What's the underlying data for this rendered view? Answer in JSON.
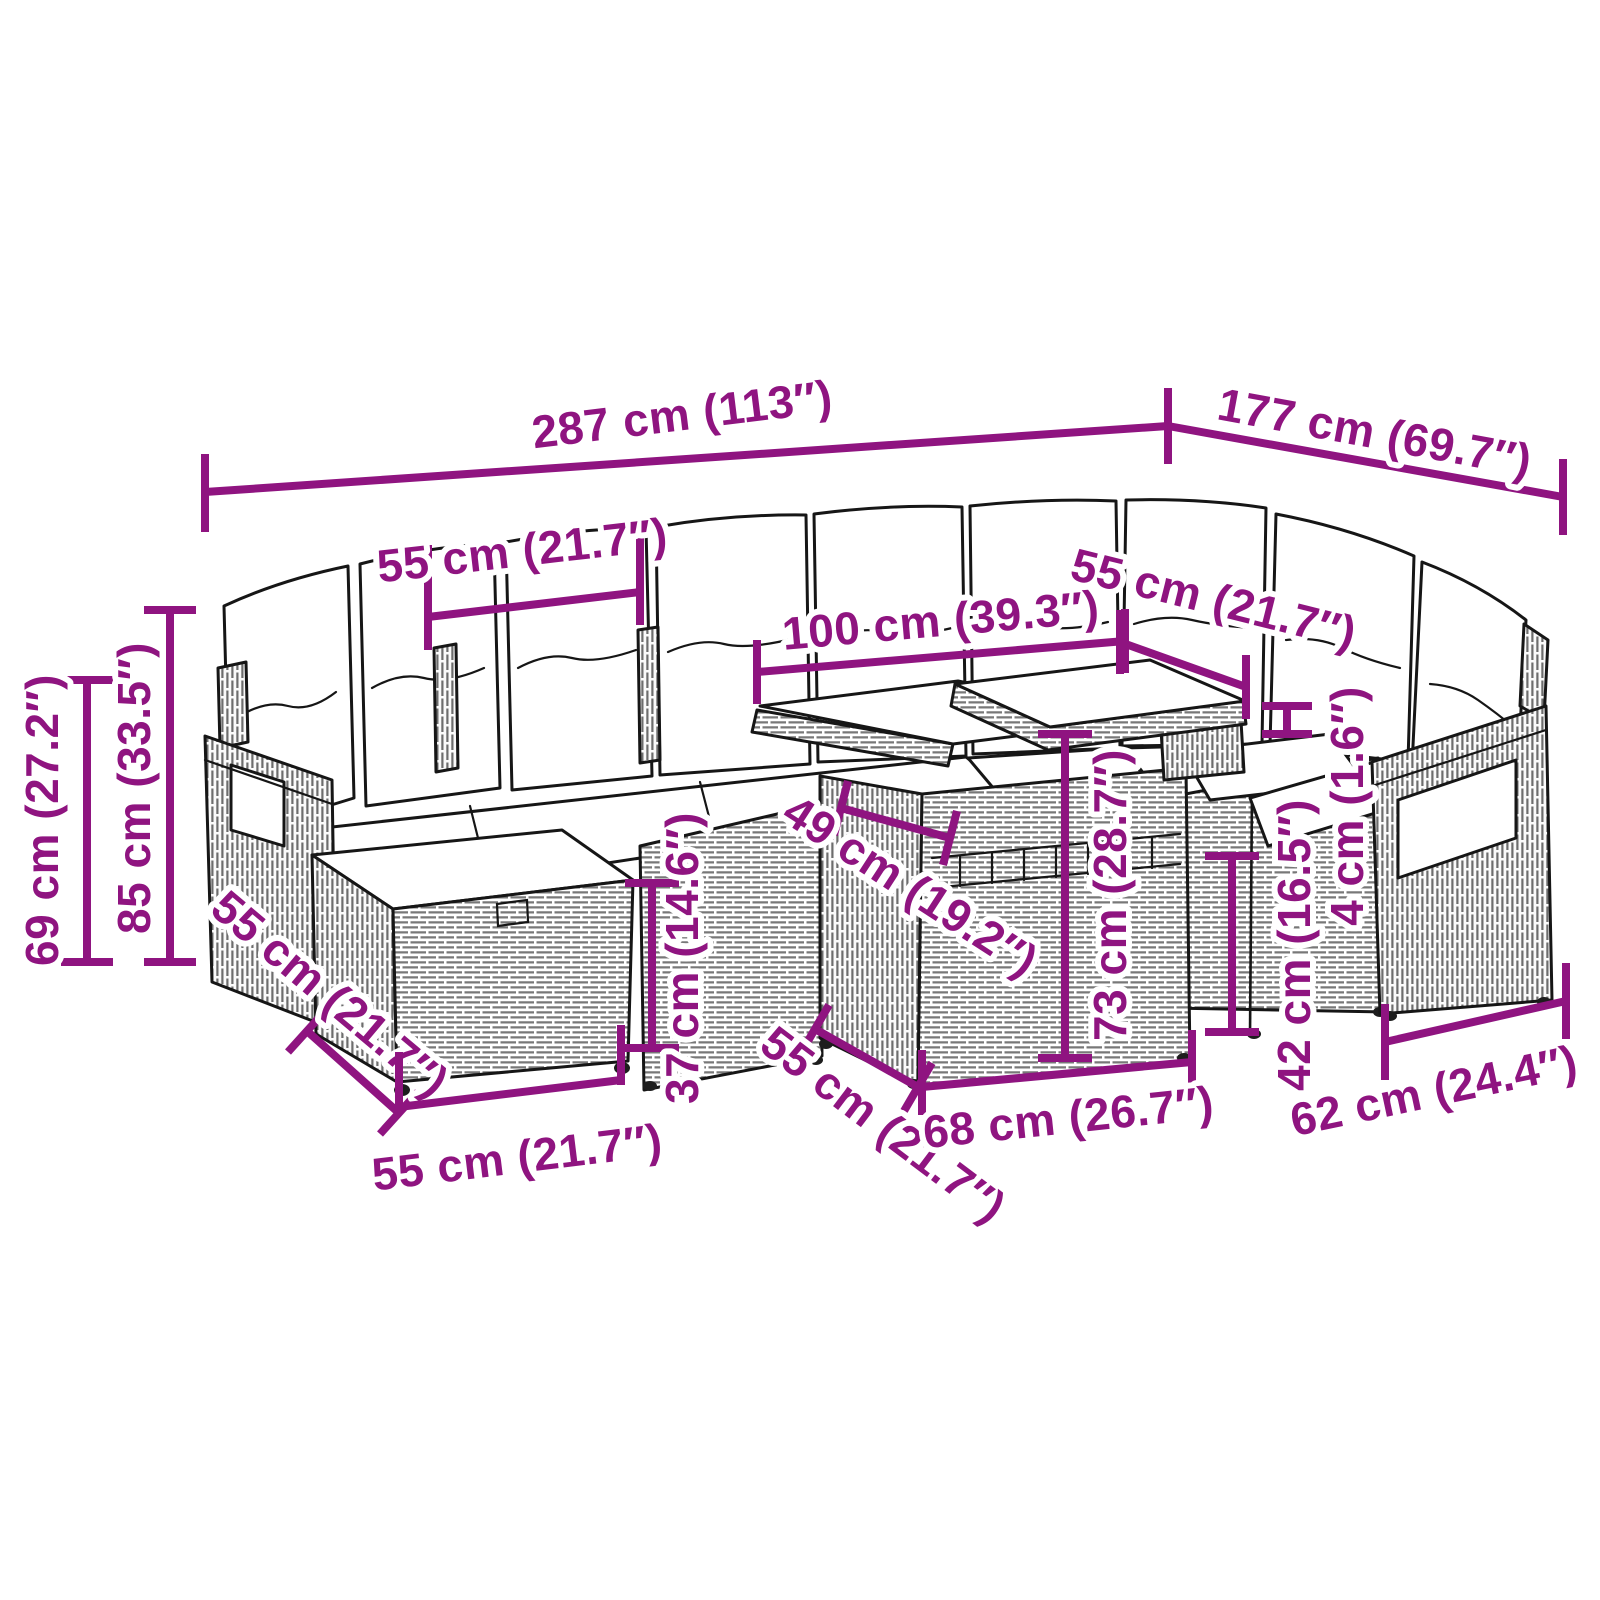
{
  "colors": {
    "accent": "#8F1480",
    "line_art": "#161616",
    "background": "#ffffff"
  },
  "illustration": {
    "style": "black-and-white line art",
    "subject": "poly-rattan corner sofa set with back pillows, seat cushions, ottomans and a two-top table"
  },
  "dimensions": [
    {
      "id": "overall-width",
      "label": "287 cm (113″)",
      "cm": 287,
      "inches": 113
    },
    {
      "id": "overall-depth",
      "label": "177 cm (69.7″)",
      "cm": 177,
      "inches": 69.7
    },
    {
      "id": "seat-width-left",
      "label": "55 cm (21.7″)",
      "cm": 55,
      "inches": 21.7
    },
    {
      "id": "table-length",
      "label": "100 cm (39.3″)",
      "cm": 100,
      "inches": 39.3
    },
    {
      "id": "seat-width-right",
      "label": "55 cm (21.7″)",
      "cm": 55,
      "inches": 21.7
    },
    {
      "id": "armrest-height",
      "label": "69 cm (27.2″)",
      "cm": 69,
      "inches": 27.2
    },
    {
      "id": "back-height",
      "label": "85 cm (33.5″)",
      "cm": 85,
      "inches": 33.5
    },
    {
      "id": "ottoman-depth",
      "label": "55 cm (21.7″)",
      "cm": 55,
      "inches": 21.7
    },
    {
      "id": "ottoman-width",
      "label": "55 cm (21.7″)",
      "cm": 55,
      "inches": 21.7
    },
    {
      "id": "seat-base-height",
      "label": "37 cm (14.6″)",
      "cm": 37,
      "inches": 14.6
    },
    {
      "id": "tabletop-depth",
      "label": "49 cm (19.2″)",
      "cm": 49,
      "inches": 19.2
    },
    {
      "id": "table-height",
      "label": "73 cm (28.7″)",
      "cm": 73,
      "inches": 28.7
    },
    {
      "id": "table-base-depth",
      "label": "55 cm (21.7″)",
      "cm": 55,
      "inches": 21.7
    },
    {
      "id": "table-base-width",
      "label": "68 cm (26.7″)",
      "cm": 68,
      "inches": 26.7
    },
    {
      "id": "seat-height-right",
      "label": "42 cm (16.5″)",
      "cm": 42,
      "inches": 16.5
    },
    {
      "id": "top-thickness",
      "label": "4 cm (1.6″)",
      "cm": 4,
      "inches": 1.6
    },
    {
      "id": "chair-width",
      "label": "62 cm (24.4″)",
      "cm": 62,
      "inches": 24.4
    }
  ]
}
